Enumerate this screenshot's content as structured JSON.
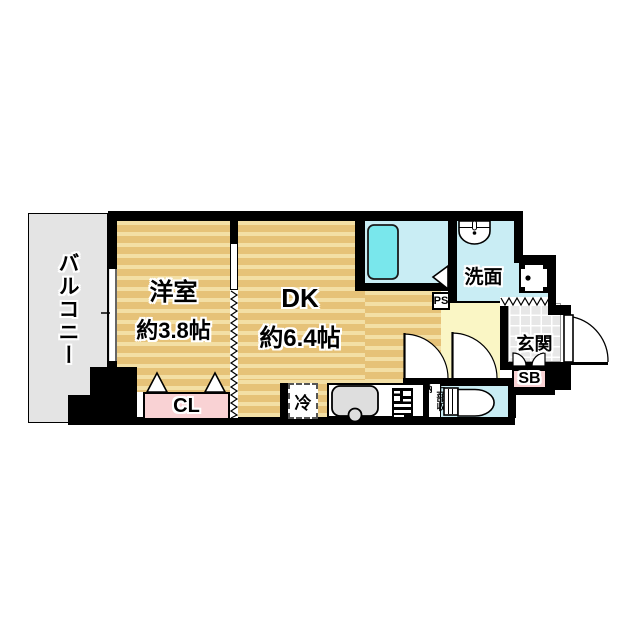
{
  "plan": {
    "type": "floorplan",
    "layout_name": "1DK"
  },
  "rooms": {
    "balcony": {
      "label": "バルコニー"
    },
    "western_room": {
      "label": "洋室",
      "size": "約3.8帖"
    },
    "dining_kitchen": {
      "label": "DK",
      "size": "約6.4帖"
    },
    "closet": {
      "label": "CL"
    },
    "washroom": {
      "label": "洗面"
    },
    "entrance": {
      "label": "玄関"
    },
    "shoe_box": {
      "label": "SB"
    },
    "pipe_space": {
      "label": "PS"
    },
    "refrigerator": {
      "label": "冷"
    },
    "upper_storage": {
      "label": "上部収納"
    }
  },
  "colors": {
    "tatami": "#e6c278",
    "tatami_stripe": "#f3dfa5",
    "water_room": "#c9edf4",
    "bathtub": "#79e7ec",
    "balcony_gray": "#e4e4e4",
    "hallway_yellow": "#faf6c5",
    "closet_pink": "#f9d2d4",
    "entrance_tile": "#e7e7e7",
    "wall_black": "#000000"
  }
}
